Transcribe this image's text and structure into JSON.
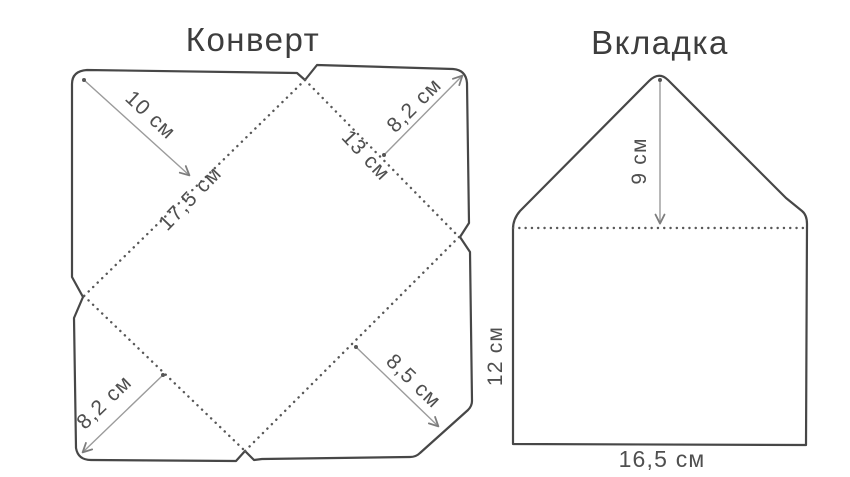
{
  "page": {
    "background": "#ffffff",
    "language": "ru"
  },
  "figures": {
    "envelope": {
      "title": "Конверт",
      "labels": {
        "top_left_flap": "10 см",
        "top_right_flap": "8,2 см",
        "left_fold": "17,5 см",
        "right_fold": "13 см",
        "bottom_left_flap": "8,2 см",
        "bottom_right_flap": "8,5 см"
      }
    },
    "insert": {
      "title": "Вкладка",
      "labels": {
        "flap_height": "9 см",
        "body_height": "12 см",
        "body_width": "16,5 см"
      }
    }
  },
  "colors": {
    "background": "#ffffff",
    "outline": "#474747",
    "fold_line": "#585858",
    "dimension_line": "#9b9b9b",
    "label_text": "#4f4f4f",
    "title_text": "#3d3d3d"
  }
}
